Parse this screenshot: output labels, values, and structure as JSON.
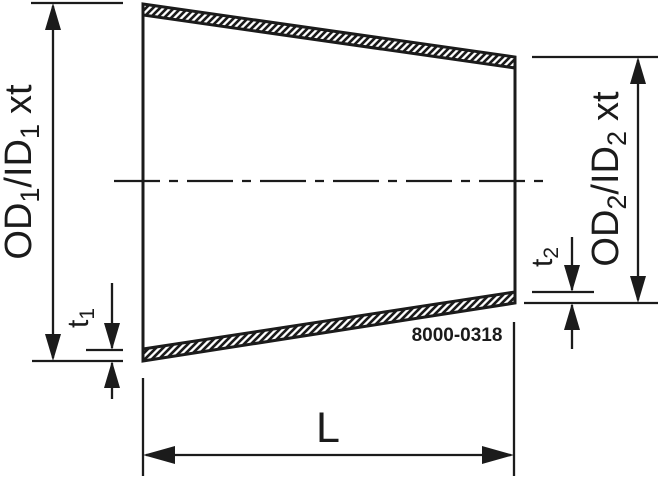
{
  "drawing": {
    "title": "concentric-reducer-dimension-drawing",
    "ink_color": "#1b1b1b",
    "background_color": "#ffffff",
    "part_number": "8000-0318",
    "labels": {
      "dim_left": {
        "p1": "OD",
        "s1": "1",
        "p2": "/ID",
        "s2": "1",
        "p3": "xt"
      },
      "dim_right": {
        "p1": "OD",
        "s1": "2",
        "p2": "/ID",
        "s2": "2",
        "p3": "xt"
      },
      "t1": {
        "p": "t",
        "s": "1"
      },
      "t2": {
        "p": "t",
        "s": "2"
      },
      "length": "L"
    }
  }
}
